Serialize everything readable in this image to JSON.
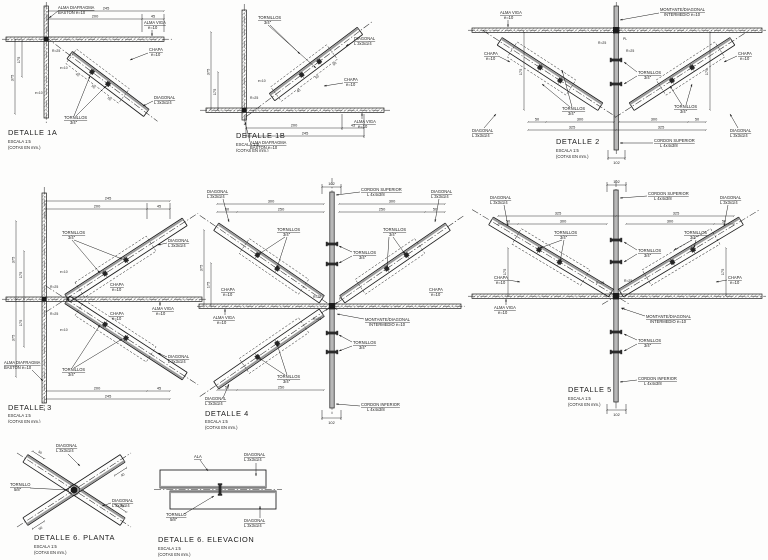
{
  "page": {
    "background": "#fdfdfc",
    "line_color": "#1b1b1b",
    "member_gray": "#b8b8b8"
  },
  "labels": {
    "escala": "ESCALA 1:5",
    "cotas": "(COTAS EN mm.)",
    "alma_diafragma_1": "ALMA DIAFRAGMA",
    "alma_diafragma_2": "BASTON e=10",
    "alma_viga_1": "ALMA VIGA",
    "alma_viga_2": "e=10",
    "chapa_1": "CHAPA",
    "chapa_2": "e=10",
    "tornillos_1": "TORNILLOS",
    "tornillos_34": "3/4\"",
    "tornillo_1": "TORNILLO",
    "tornillo_58": "5/8\"",
    "diagonal_1": "DIAGONAL",
    "diagonal_2": "L 3x3x1/4",
    "montante_1": "MONTANTE/DIAGONAL",
    "montante_2": "INTERMEDIO e=10",
    "cordon_sup": "CORDON SUPERIOR",
    "cordon_inf": "CORDON INFERIOR",
    "cordon_size": "L 4x4x3/8",
    "ala": "ALA",
    "r25": "R=25",
    "pl": "PL",
    "e10": "e=10"
  },
  "details": {
    "d1a": {
      "title": "DETALLE  1A",
      "dims": [
        "245",
        "200",
        "45",
        "175",
        "375",
        "40",
        "50",
        "50"
      ]
    },
    "d1b": {
      "title": "DETALLE  1B",
      "dims": [
        "245",
        "200",
        "45",
        "175",
        "375",
        "40",
        "50",
        "50"
      ]
    },
    "d2": {
      "title": "DETALLE  2",
      "dims": [
        "50",
        "300",
        "300",
        "50",
        "325",
        "325",
        "102",
        "175",
        "175"
      ]
    },
    "d3": {
      "title": "DETALLE  3",
      "dims": [
        "245",
        "200",
        "45",
        "245",
        "200",
        "45",
        "175",
        "375",
        "175",
        "375"
      ]
    },
    "d4": {
      "title": "DETALLE  4",
      "dims": [
        "102",
        "50",
        "250",
        "250",
        "50",
        "300",
        "300",
        "102",
        "175",
        "375",
        "250",
        "50"
      ]
    },
    "d5": {
      "title": "DETALLE  5",
      "dims": [
        "102",
        "50",
        "300",
        "300",
        "50",
        "325",
        "325",
        "102",
        "175",
        "175"
      ]
    },
    "d6p": {
      "title": "DETALLE  6.  PLANTA",
      "dims": [
        "50",
        "40",
        "50",
        "40"
      ]
    },
    "d6e": {
      "title": "DETALLE  6.  ELEVACION"
    }
  }
}
